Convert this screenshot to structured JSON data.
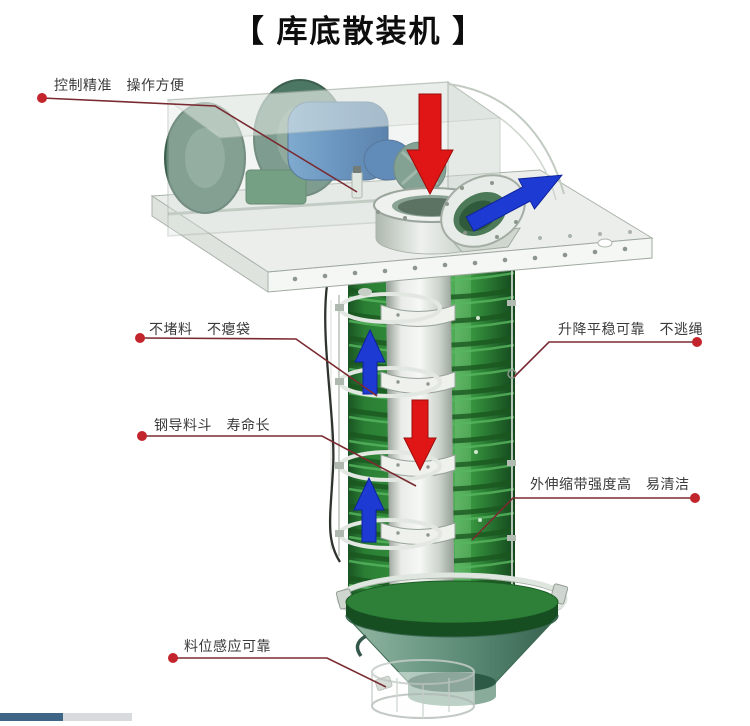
{
  "title": "【 库底散装机 】",
  "callouts": {
    "control": {
      "label": "控制精准　操作方便"
    },
    "no_clog": {
      "label": "不堵料　不瘪袋"
    },
    "steel_hopper": {
      "label": "钢导料斗　寿命长"
    },
    "lifting": {
      "label": "升降平稳可靠　不逃绳"
    },
    "outer_belt": {
      "label": "外伸缩带强度高　易清洁"
    },
    "level_sensor": {
      "label": "料位感应可靠"
    }
  },
  "colors": {
    "callout_line": "#7a2b31",
    "callout_dot": "#c2252b",
    "flow_down_arrow_red": "#e01515",
    "flow_up_arrow_blue": "#1d3bd2",
    "bellows_green": "#37953f",
    "hopper_green": "#5f9180",
    "motor_blue": "#2e6cb0",
    "progress_blue": "#3f6586",
    "progress_gray": "#d7dbdd"
  }
}
